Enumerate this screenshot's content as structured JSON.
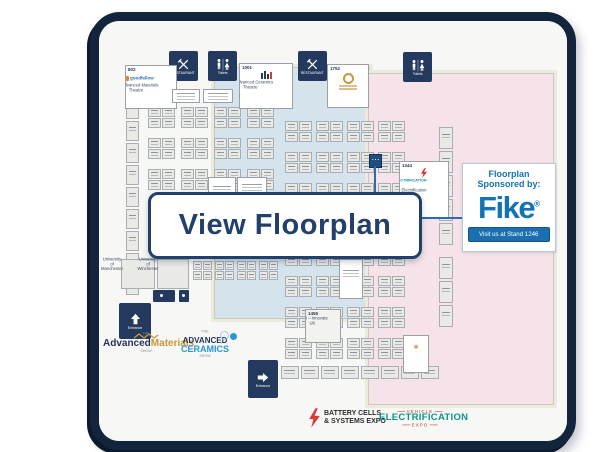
{
  "overlay": {
    "view_button": "View Floorplan"
  },
  "sponsor": {
    "heading1": "Floorplan",
    "heading2": "Sponsored by:",
    "logo": "Fike",
    "registered": "®",
    "cta": "Visit us at Stand 1246"
  },
  "amenities": [
    {
      "id": "restaurant-1",
      "label": "RESTAURANT"
    },
    {
      "id": "toilets-1",
      "label": "Toilets"
    },
    {
      "id": "restaurant-2",
      "label": "RESTAURANT"
    },
    {
      "id": "toilets-2",
      "label": "Toilets"
    }
  ],
  "entrances": {
    "up": "Entrance",
    "right": "Entrance"
  },
  "booths": {
    "b802": {
      "number": "802",
      "logo": "goodfellow",
      "caption": "The Advanced Materials Theatre"
    },
    "b1001": {
      "number": "1001",
      "caption": "The Advanced Ceramics Theatre"
    },
    "b1752": {
      "number": "1752"
    },
    "b1344": {
      "number": "1344",
      "line2": "ELECTRIFICATION",
      "caption": "The Electrification Theatre"
    },
    "b1455": {
      "number": "1455",
      "caption": "UKRI – Innovate UK"
    },
    "uni1": {
      "caption": "University of Manchester"
    },
    "uni2": {
      "caption": "University of Winchester"
    }
  },
  "logos": {
    "materials": {
      "the": "THE",
      "l1": "Advanced",
      "l2": "Materials",
      "show": "SHOW"
    },
    "ceramics": {
      "the": "THE",
      "l1": "ADVANCED",
      "l2": "CERAMICS",
      "show": "SHOW"
    },
    "battery": {
      "l1": "BATTERY CELLS",
      "l2": "& SYSTEMS EXPO"
    },
    "vehicle": {
      "l1": "VEHICLE",
      "l2": "ELECTRIFICATION",
      "l3": "EXPO"
    }
  },
  "colors": {
    "frame_navy": "#13243d",
    "icon_navy": "#24395e",
    "hall_blue": "#d5e3ed",
    "hall_pink": "#f5e3e9",
    "button_navy": "#21406b",
    "fike_blue": "#1273b8",
    "accent_gold": "#c9973a",
    "accent_red": "#d9342b",
    "accent_teal": "#0a9488"
  },
  "grid": {
    "halls": [
      {
        "name": "hall-blue",
        "grids": [
          {
            "x0": 139,
            "y0": 98,
            "dx": 33,
            "dy": 31,
            "nx": 4,
            "ny": 5,
            "cols": 2,
            "rows": 2,
            "cw": 13,
            "ch": 10,
            "gap": 1
          },
          {
            "x0": 117,
            "y0": 90,
            "dx": 0,
            "dy": 22,
            "nx": 1,
            "ny": 9,
            "cols": 1,
            "rows": 1,
            "cw": 13,
            "ch": 20,
            "gap": 0
          },
          {
            "x0": 184,
            "y0": 252,
            "dx": 22,
            "dy": 0,
            "nx": 4,
            "ny": 1,
            "cols": 2,
            "rows": 2,
            "cw": 9,
            "ch": 9,
            "gap": 1
          }
        ]
      },
      {
        "name": "hall-pink",
        "grids": [
          {
            "x0": 276,
            "y0": 112,
            "dx": 31,
            "dy": 31,
            "nx": 4,
            "ny": 8,
            "cols": 2,
            "rows": 2,
            "cw": 13,
            "ch": 10,
            "gap": 1
          },
          {
            "x0": 430,
            "y0": 118,
            "dx": 0,
            "dy": 24,
            "nx": 1,
            "ny": 5,
            "cols": 1,
            "rows": 1,
            "cw": 14,
            "ch": 22,
            "gap": 0
          },
          {
            "x0": 430,
            "y0": 248,
            "dx": 0,
            "dy": 24,
            "nx": 1,
            "ny": 3,
            "cols": 1,
            "rows": 1,
            "cw": 14,
            "ch": 22,
            "gap": 0
          },
          {
            "x0": 272,
            "y0": 357,
            "dx": 20,
            "dy": 0,
            "nx": 8,
            "ny": 1,
            "cols": 1,
            "rows": 1,
            "cw": 18,
            "ch": 13,
            "gap": 0
          }
        ]
      }
    ]
  }
}
